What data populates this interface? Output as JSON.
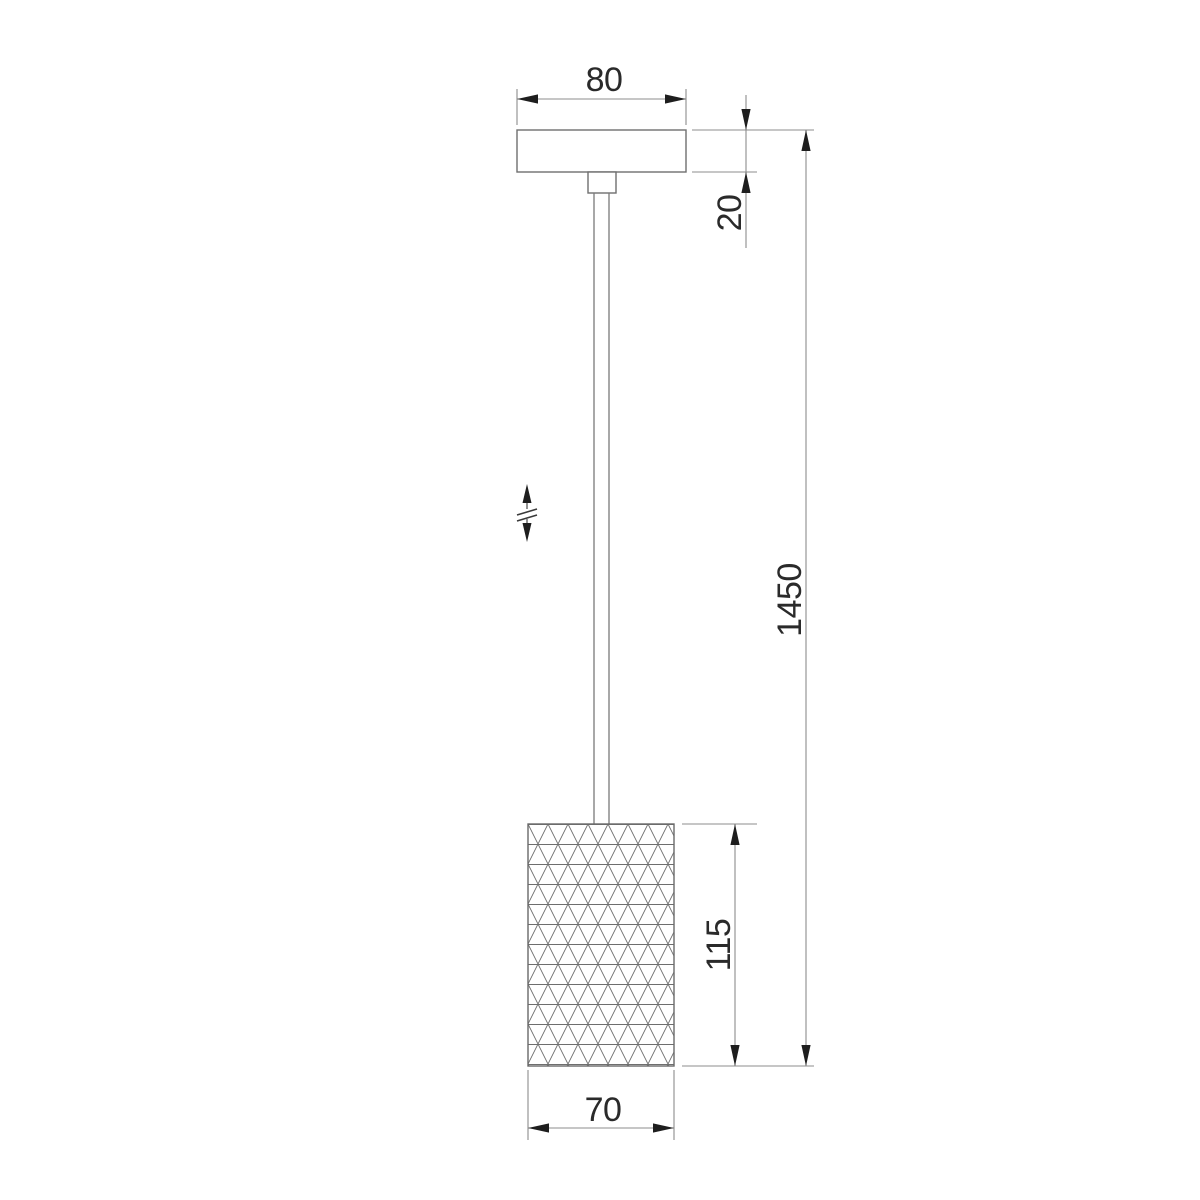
{
  "drawing": {
    "description": "pendant-lamp-dimension-drawing",
    "dimensions": {
      "canopy_width": "80",
      "canopy_height": "20",
      "overall_height": "1450",
      "shade_height": "115",
      "shade_width": "70"
    },
    "icons": {
      "height_adjust": "double-arrow-with-break-icon"
    },
    "colors": {
      "background": "#ffffff",
      "object_line": "#6f6f6f",
      "dimension_line": "#8c8c8c",
      "pattern_line": "#6e6e6e",
      "arrow": "#1e1e1e",
      "text": "#2a2a2a"
    }
  }
}
